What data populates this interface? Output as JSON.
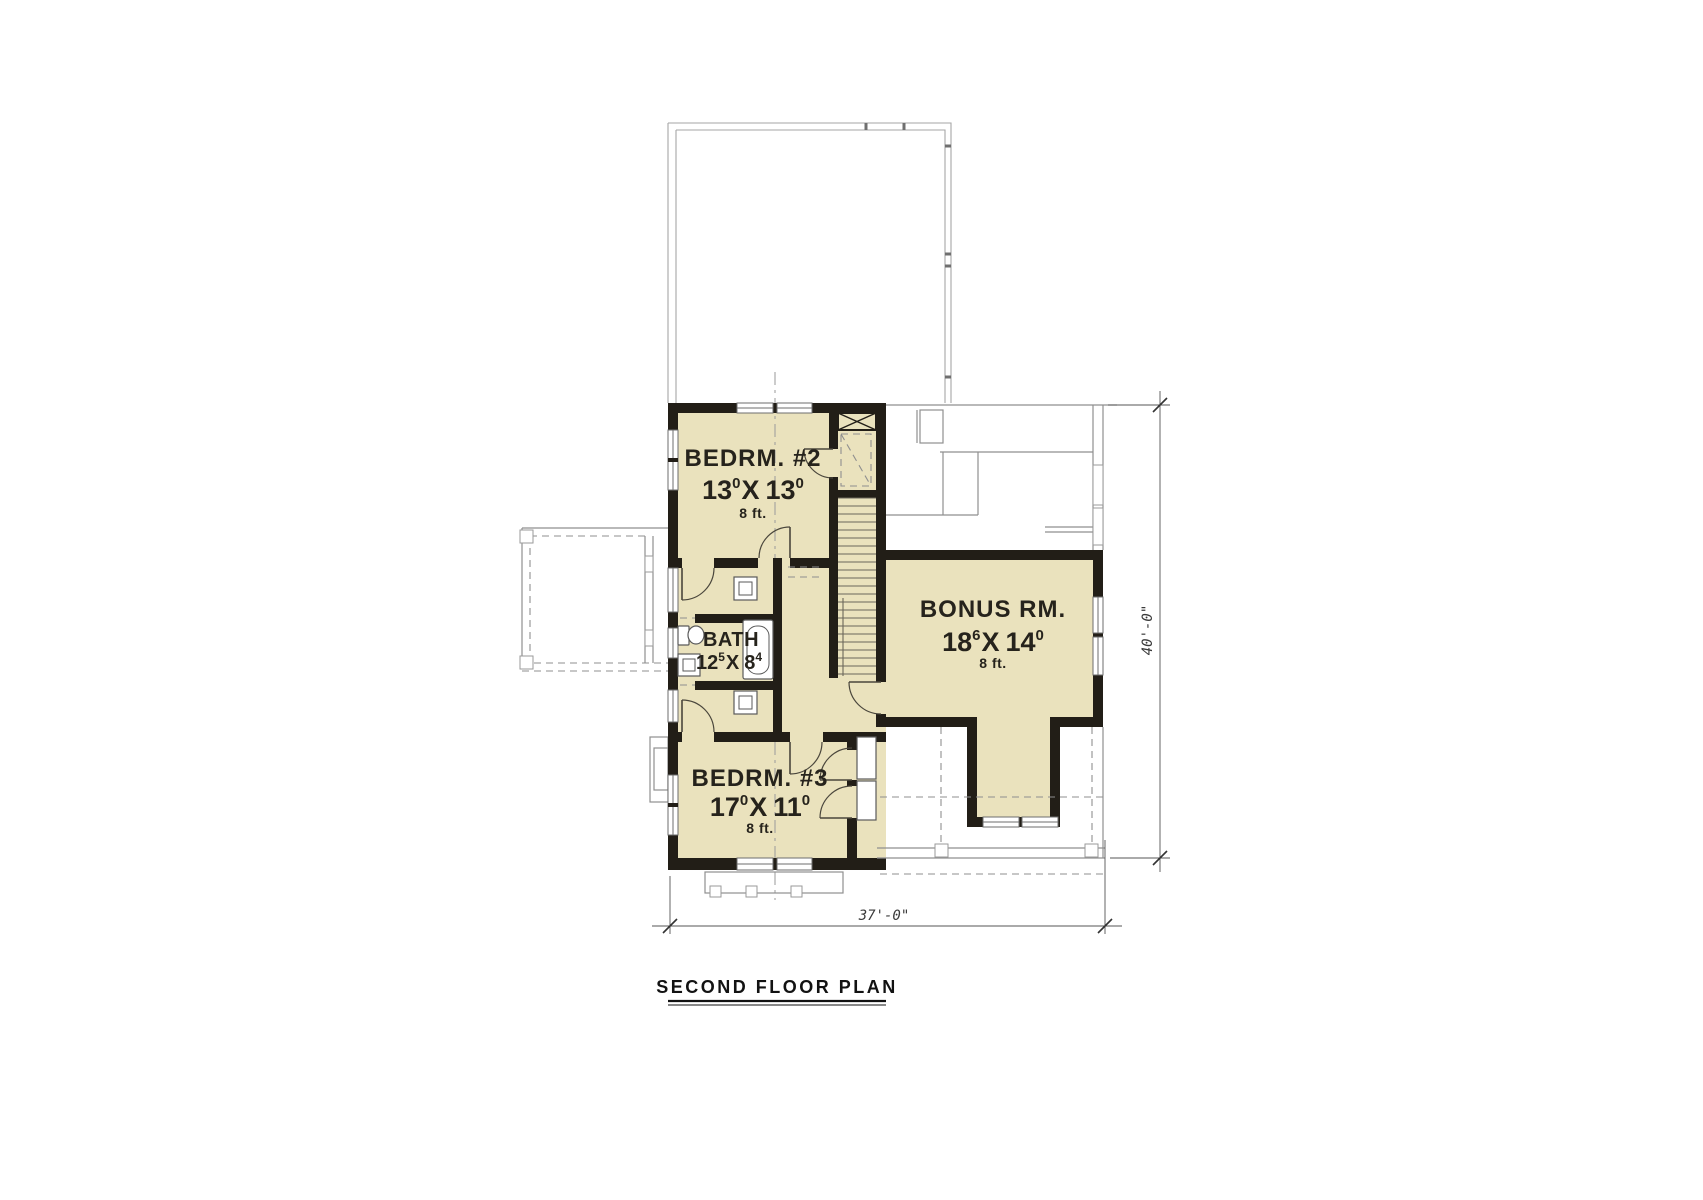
{
  "drawing": {
    "title": "SECOND FLOOR PLAN",
    "rooms": [
      {
        "name": "BEDRM. #2",
        "w_ft": "13",
        "w_in": "0",
        "sep": "X",
        "h_ft": "13",
        "h_in": "0",
        "ceiling": "8 ft."
      },
      {
        "name": "BATH",
        "w_ft": "12",
        "w_in": "5",
        "sep": "X",
        "h_ft": "8",
        "h_in": "4"
      },
      {
        "name": "BONUS RM.",
        "w_ft": "18",
        "w_in": "6",
        "sep": "X",
        "h_ft": "14",
        "h_in": "0",
        "ceiling": "8 ft."
      },
      {
        "name": "BEDRM. #3",
        "w_ft": "17",
        "w_in": "0",
        "sep": "X",
        "h_ft": "11",
        "h_in": "0",
        "ceiling": "8 ft."
      }
    ],
    "dimensions": {
      "overall_width": "37'-0\"",
      "overall_depth": "40'-0\""
    },
    "colors": {
      "room_fill": "#eae2bd",
      "wall": "#221e17",
      "reference_line": "#8f8f8f",
      "dimension_text": "#3a3a3a",
      "background": "#ffffff"
    }
  }
}
